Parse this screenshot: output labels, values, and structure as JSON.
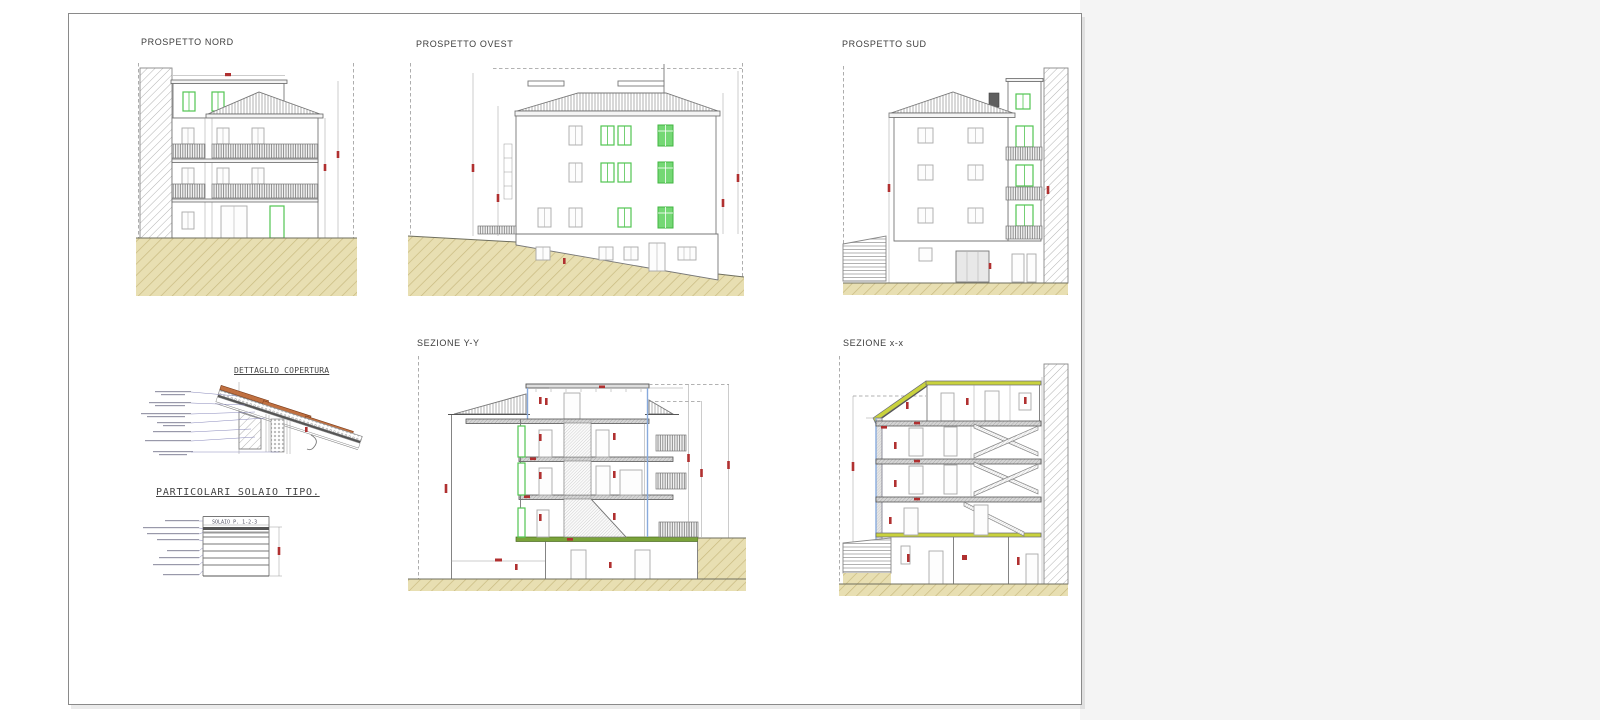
{
  "page": {
    "background": "#ffffff",
    "right_panel_color": "#f4f4f4",
    "sheet_border_color": "#8a8a8a"
  },
  "drawings": {
    "prospetto_nord": {
      "title": "PROSPETTO NORD"
    },
    "prospetto_ovest": {
      "title": "PROSPETTO OVEST"
    },
    "prospetto_sud": {
      "title": "PROSPETTO SUD"
    },
    "dettaglio_copertura": {
      "title": "DETTAGLIO COPERTURA"
    },
    "particolari_solaio": {
      "title": "PARTICOLARI SOLAIO TIPO.",
      "slab_label": "SOLAIO P. 1-2-3"
    },
    "sezione_yy": {
      "title": "SEZIONE Y-Y"
    },
    "sezione_xx": {
      "title": "SEZIONE x-x"
    }
  },
  "colors": {
    "window_green": "#52c552",
    "dimension_red": "#b03030",
    "ground_tan": "#e8dfb2",
    "roof_deck_yellow_green": "#c9d23d",
    "tile_orange": "#c07040"
  }
}
